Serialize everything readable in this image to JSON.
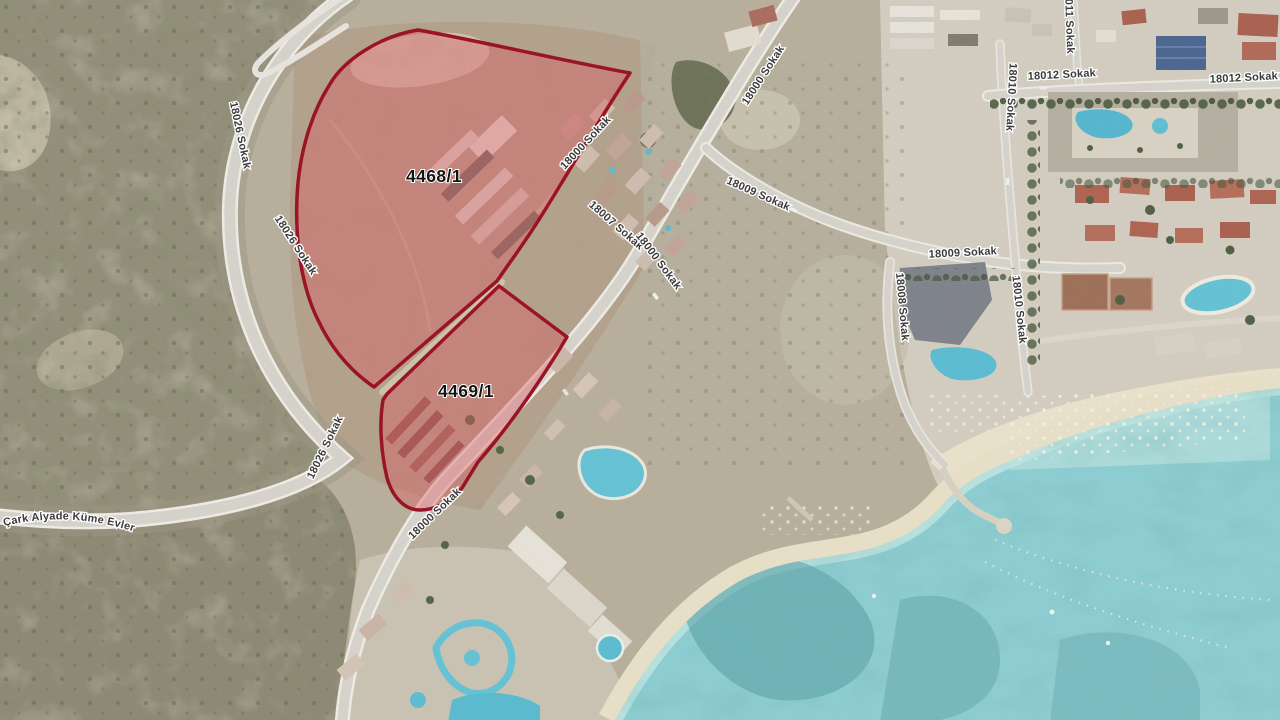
{
  "map": {
    "kind": "satellite-cadastral-view",
    "labels": {
      "parcels": [
        {
          "text": "4468/1"
        },
        {
          "text": "4469/1"
        }
      ],
      "streets": [
        {
          "text": "18026 Sokak"
        },
        {
          "text": "18026 Sokak"
        },
        {
          "text": "18026 Sokak"
        },
        {
          "text": "18000 Sokak"
        },
        {
          "text": "18009 Sokak"
        },
        {
          "text": "18000 Sokak"
        },
        {
          "text": "18007 Sokak"
        },
        {
          "text": "18000 Sokak"
        },
        {
          "text": "18000 Sokak"
        },
        {
          "text": "18009 Sokak"
        },
        {
          "text": "18008 Sokak"
        },
        {
          "text": "18010 Sokak"
        },
        {
          "text": "18010 Sokak"
        },
        {
          "text": "18011 Sokak"
        },
        {
          "text": "18012 Sokak"
        },
        {
          "text": "18012 Sokak"
        }
      ],
      "place": "Çark Alyade Küme Evler"
    },
    "colors": {
      "parcel_outline": "#9a1426",
      "parcel_fill": "#e05660",
      "parcel_fill_opacity": "0.38",
      "sea": "#89ced3",
      "sand": "#ece3cb",
      "road": "#d9d7d0",
      "hillside": "#8f8b75",
      "dirt": "#b2a08a",
      "label_text": "#3b3b3b",
      "label_halo": "#ffffff"
    }
  }
}
